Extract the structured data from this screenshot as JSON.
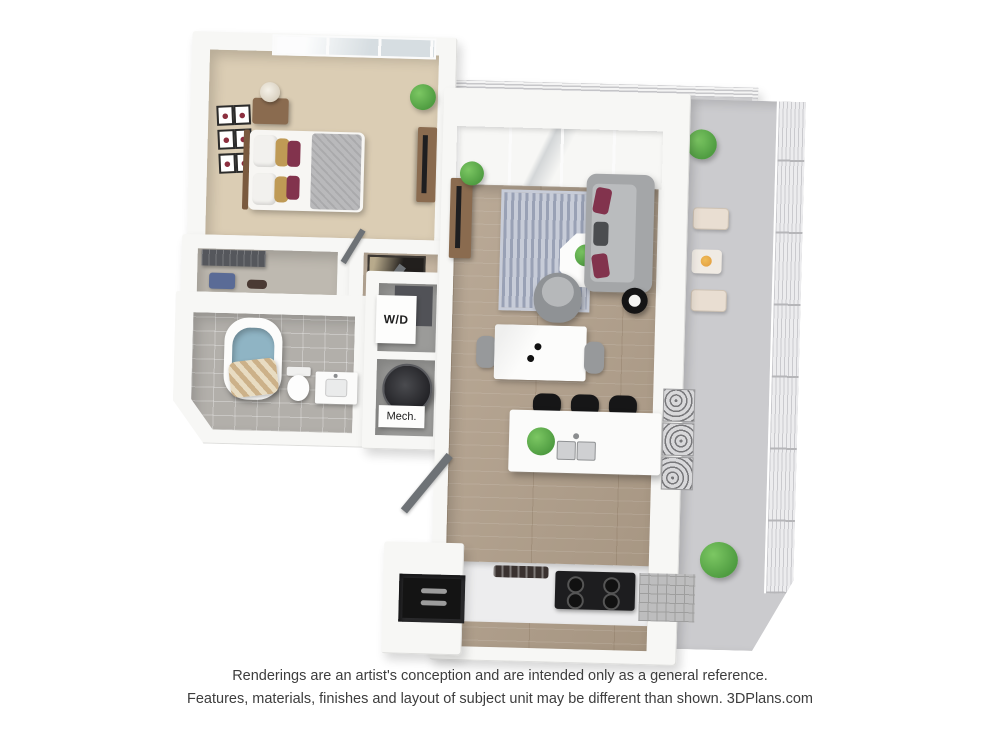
{
  "plan": {
    "labels": {
      "washer_dryer": "W/D",
      "mechanical": "Mech."
    },
    "colors": {
      "wall": "#f7f7f5",
      "wall_edge": "#dddddb",
      "wood": "#b2a08b",
      "carpet": "#dbcdb4",
      "closet_floor": "#beb9b0",
      "tile": "#b2afaa",
      "balcony": "#cbcbce",
      "balcony_top": "#e0e0e2",
      "rug_light": "#c7ccd8",
      "rug_dark": "#99a1b5",
      "sofa": "#a4a6a8",
      "pillow_accent": "#82334d",
      "pillow_gold": "#bf9a55",
      "plant": "#4f9c41",
      "water": "#8fb4c4",
      "curtain": "#ccb189",
      "appliance_dark": "#1d1d1f",
      "door": "#6e7276",
      "wood_furniture": "#8a6b4f"
    }
  },
  "disclaimer": {
    "line1": "Renderings are an artist's conception and are intended only as a general reference.",
    "line2": "Features, materials, finishes and layout of subject unit may be different than shown. 3DPlans.com"
  }
}
